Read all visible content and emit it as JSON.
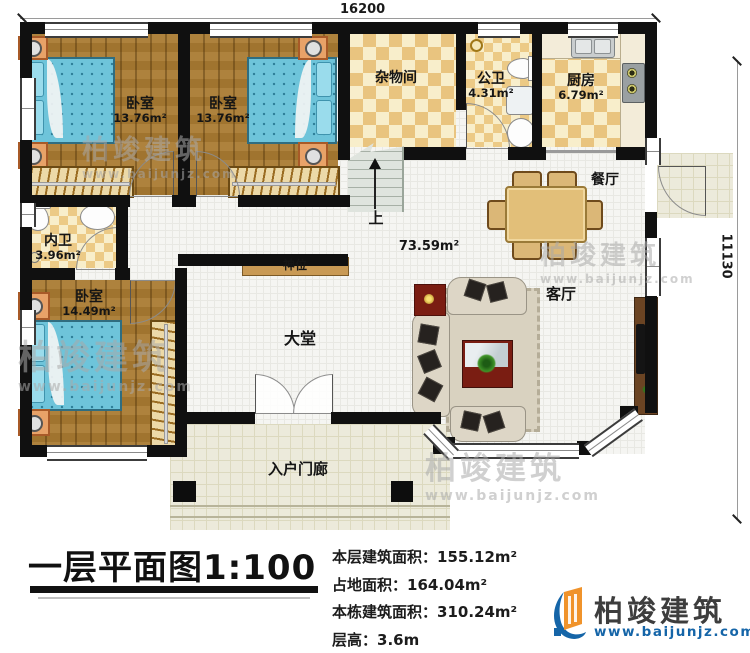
{
  "plan": {
    "dimensions": {
      "top": "16200",
      "right": "11130"
    },
    "rooms": {
      "bedroom1": {
        "name": "卧室",
        "area": "13.76m²"
      },
      "bedroom2": {
        "name": "卧室",
        "area": "13.76m²"
      },
      "storage": {
        "name": "杂物间"
      },
      "public_bath": {
        "name": "公卫",
        "area": "4.31m²"
      },
      "kitchen": {
        "name": "厨房",
        "area": "6.79m²"
      },
      "dining": {
        "name": "餐厅"
      },
      "ensuite_bath": {
        "name": "内卫",
        "area": "3.96m²"
      },
      "bedroom3": {
        "name": "卧室",
        "area": "14.49m²"
      },
      "hall": {
        "name": "大堂"
      },
      "living": {
        "name": "客厅"
      },
      "entry_porch": {
        "name": "入户门廊"
      },
      "shrine": {
        "name": "神位"
      }
    },
    "stairs": {
      "up_label": "上"
    },
    "open_area": "73.59m²"
  },
  "titleblock": {
    "title": "一层平面图1:100",
    "stats": [
      {
        "label": "本层建筑面积：",
        "value": "155.12m²"
      },
      {
        "label": "占地面积：",
        "value": "164.04m²"
      },
      {
        "label": "本栋建筑面积：",
        "value": "310.24m²"
      },
      {
        "label": "层高：",
        "value": "3.6m"
      }
    ]
  },
  "logo": {
    "brand": "柏竣建筑",
    "url": "www.baijunjz.com"
  },
  "watermark": {
    "brand": "柏竣建筑",
    "url": "www.baijunjz.com"
  },
  "colors": {
    "wall": "#101010",
    "wood_floor": "#a97a31",
    "checker_tile": "#e9c47f",
    "bed": "#6ec4da",
    "logo_blue": "#1565a8",
    "logo_orange": "#f0932b"
  }
}
